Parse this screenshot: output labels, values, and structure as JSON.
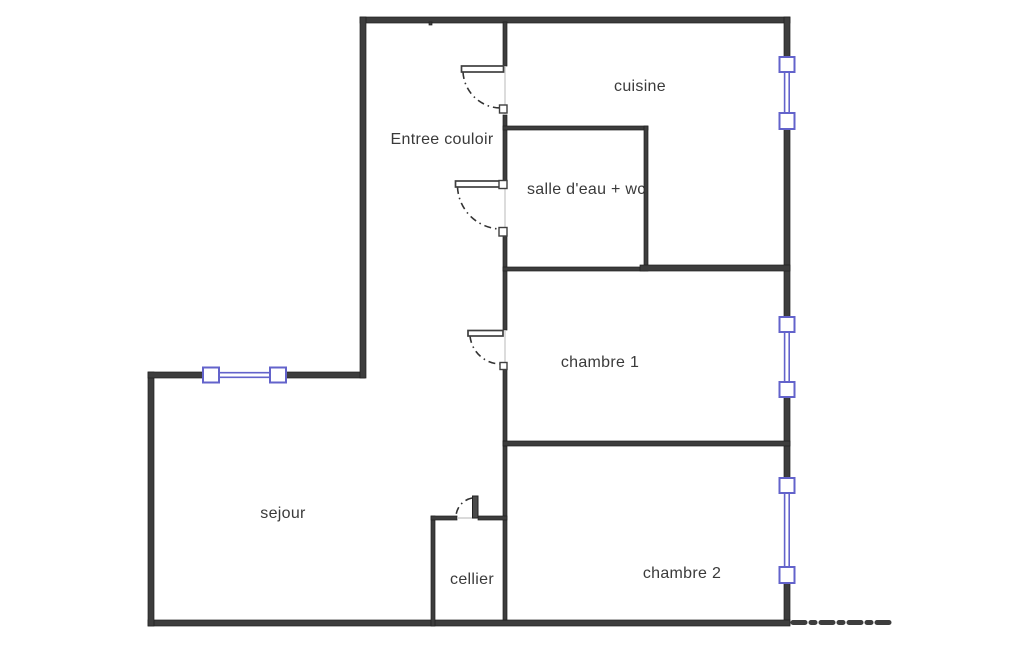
{
  "diagram": {
    "type": "apartment-floor-plan"
  },
  "rooms": [
    {
      "name": "entree-couloir",
      "label": "Entree couloir"
    },
    {
      "name": "cuisine",
      "label": "cuisine"
    },
    {
      "name": "salle-deau-wc",
      "label": "salle d'eau + wc"
    },
    {
      "name": "chambre-1",
      "label": "chambre 1"
    },
    {
      "name": "sejour",
      "label": "sejour"
    },
    {
      "name": "cellier",
      "label": "cellier"
    },
    {
      "name": "chambre-2",
      "label": "chambre 2"
    }
  ],
  "symbols": {
    "windows": [
      {
        "name": "window-cuisine-right-wall"
      },
      {
        "name": "window-chambre-1-right-wall"
      },
      {
        "name": "window-chambre-2-right-wall"
      },
      {
        "name": "window-sejour-top-wall"
      }
    ],
    "doors": [
      {
        "name": "door-entree-to-cuisine"
      },
      {
        "name": "door-salle-deau"
      },
      {
        "name": "door-chambre-1"
      },
      {
        "name": "door-cellier"
      }
    ]
  },
  "colors": {
    "wall": "#3d3d3d",
    "window": "#6363cb",
    "text": "#3a3a3a",
    "door": "#3f3f3f",
    "opening": "#c4c4c4",
    "background": "#ffffff"
  }
}
